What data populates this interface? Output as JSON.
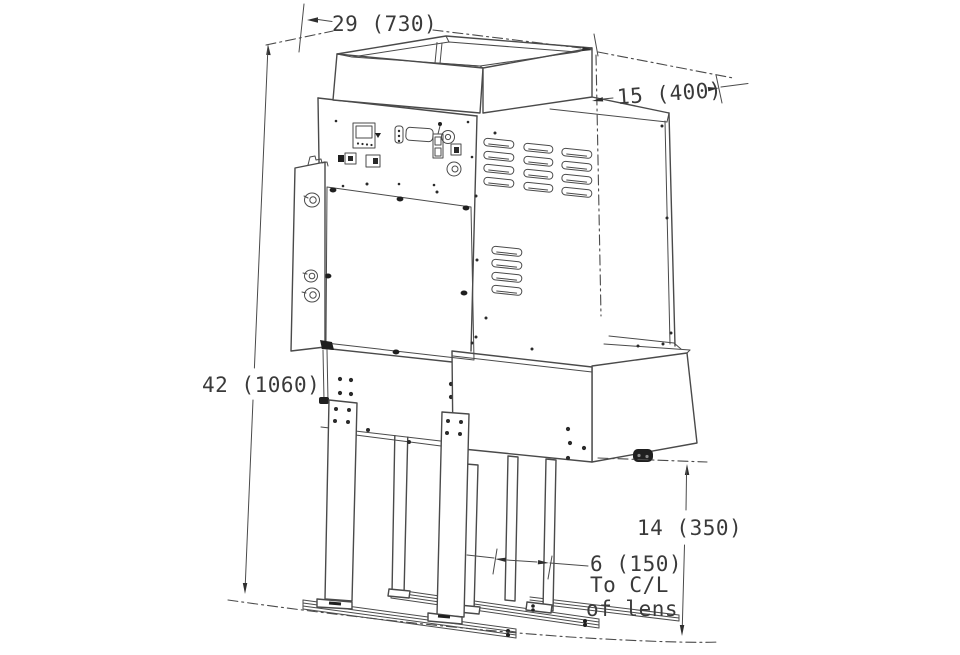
{
  "drawing": {
    "type": "isometric dimension drawing of floor-standing projection machine",
    "dimensions": {
      "top_width": {
        "label": "29 (730)"
      },
      "depth": {
        "label": "15 (400)"
      },
      "overall_height": {
        "label": "42 (1060)"
      },
      "lens_height": {
        "label": "14 (350)"
      },
      "lens_offset": {
        "label": "6 (150)",
        "note_line1": "To C/L",
        "note_line2": "of lens"
      }
    },
    "colors": {
      "line": "#4a4a4a",
      "text": "#3a3a3a",
      "dark_detail": "#1f1f1f",
      "background": "#ffffff"
    }
  }
}
